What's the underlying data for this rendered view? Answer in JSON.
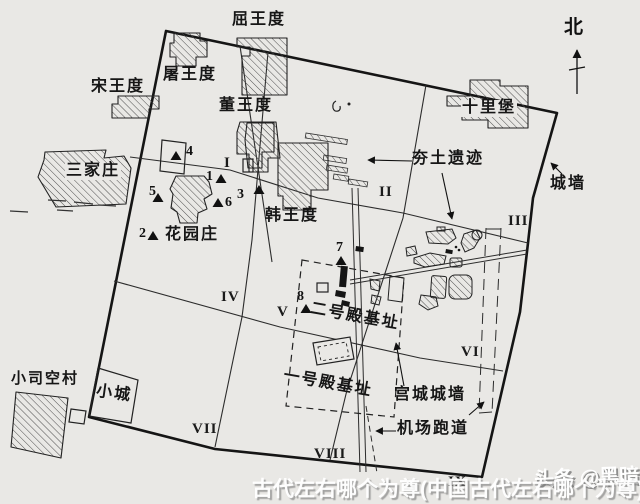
{
  "map": {
    "north": "北",
    "villages": {
      "quwangdu": "屈王度",
      "songwangdu": "宋王度",
      "tuwangdu": "屠王度",
      "dongwangdu": "董王度",
      "shilipu": "十里堡",
      "sanjiazhuang": "三家庄",
      "hanwangdu": "韩王度",
      "huayuanzhuang": "花园庄",
      "xiaosikongcun": "小司空村",
      "xiaocheng": "小城"
    },
    "features": {
      "hangtu": "夯土遗迹",
      "chengqiang": "城墙",
      "gongcheng": "宫城城墙",
      "jichang": "机场跑道",
      "dianyi": "一号殿基址",
      "dianer": "二号殿基址"
    },
    "zones": {
      "z1": "I",
      "z2": "II",
      "z3": "III",
      "z4": "IV",
      "z5": "V",
      "z6": "VI",
      "z7": "VII",
      "z8": "VIII",
      "z9": "IX"
    },
    "markers": {
      "m1": "1",
      "m2": "2",
      "m3": "3",
      "m4": "4",
      "m5": "5",
      "m6": "6",
      "m7": "7",
      "m8": "8"
    }
  },
  "watermark": {
    "caption": "古代左右哪个为尊(中国古代左右哪个为尊)",
    "logo": "头条 @黑暗"
  },
  "colors": {
    "paper": "#e9e8e5",
    "ink": "#1a1a1a"
  }
}
